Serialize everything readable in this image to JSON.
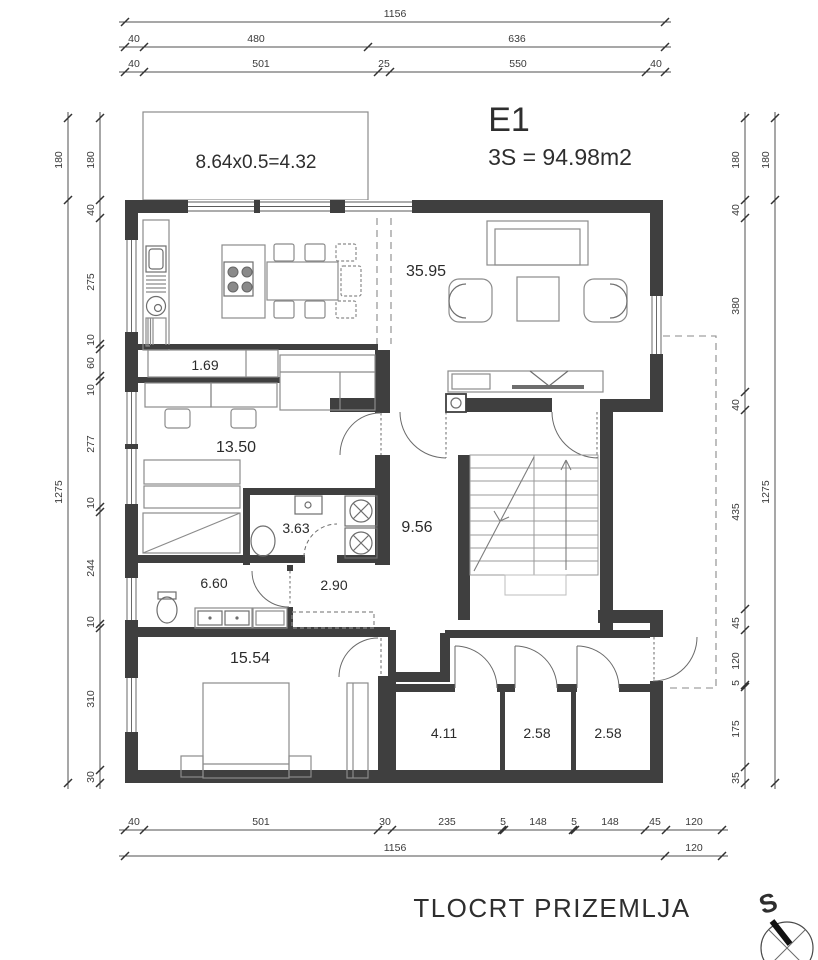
{
  "palette": {
    "wall": "#3f3f3f",
    "line": "#4f4f4f",
    "furniture": "#8b8b8b",
    "dimension_text": "#3a3a3a",
    "background": "#ffffff"
  },
  "header": {
    "unit_label": "E1",
    "area_label": "3S = 94.98m2"
  },
  "balcony": {
    "label": "8.64x0.5=4.32"
  },
  "rooms": {
    "living_dining": "35.95",
    "pantry": "1.69",
    "study": "13.50",
    "bath_small": "3.63",
    "hall": "9.56",
    "corridor": "2.90",
    "bath_large": "6.60",
    "bedroom": "15.54",
    "storage_a": "4.11",
    "storage_b": "2.58",
    "storage_c": "2.58"
  },
  "dims": {
    "top1": [
      "1156"
    ],
    "top2": [
      "40",
      "480",
      "636"
    ],
    "top3": [
      "40",
      "501",
      "25",
      "550",
      "40"
    ],
    "bottom1": [
      "40",
      "501",
      "30",
      "235",
      "5",
      "148",
      "5",
      "148",
      "45",
      "120"
    ],
    "bottom2": [
      "1156",
      "120"
    ],
    "left_outer": [
      "180",
      "1275"
    ],
    "left_inner": [
      "180",
      "40",
      "275",
      "10",
      "60",
      "10",
      "277",
      "10",
      "244",
      "10",
      "310",
      "30"
    ],
    "right_inner": [
      "180",
      "40",
      "380",
      "40",
      "435",
      "45",
      "120",
      "5",
      "175",
      "35"
    ],
    "right_outer": [
      "180",
      "1275"
    ]
  },
  "footer": {
    "drawing_title": "TLOCRT PRIZEMLJA",
    "compass_letter": "S"
  }
}
